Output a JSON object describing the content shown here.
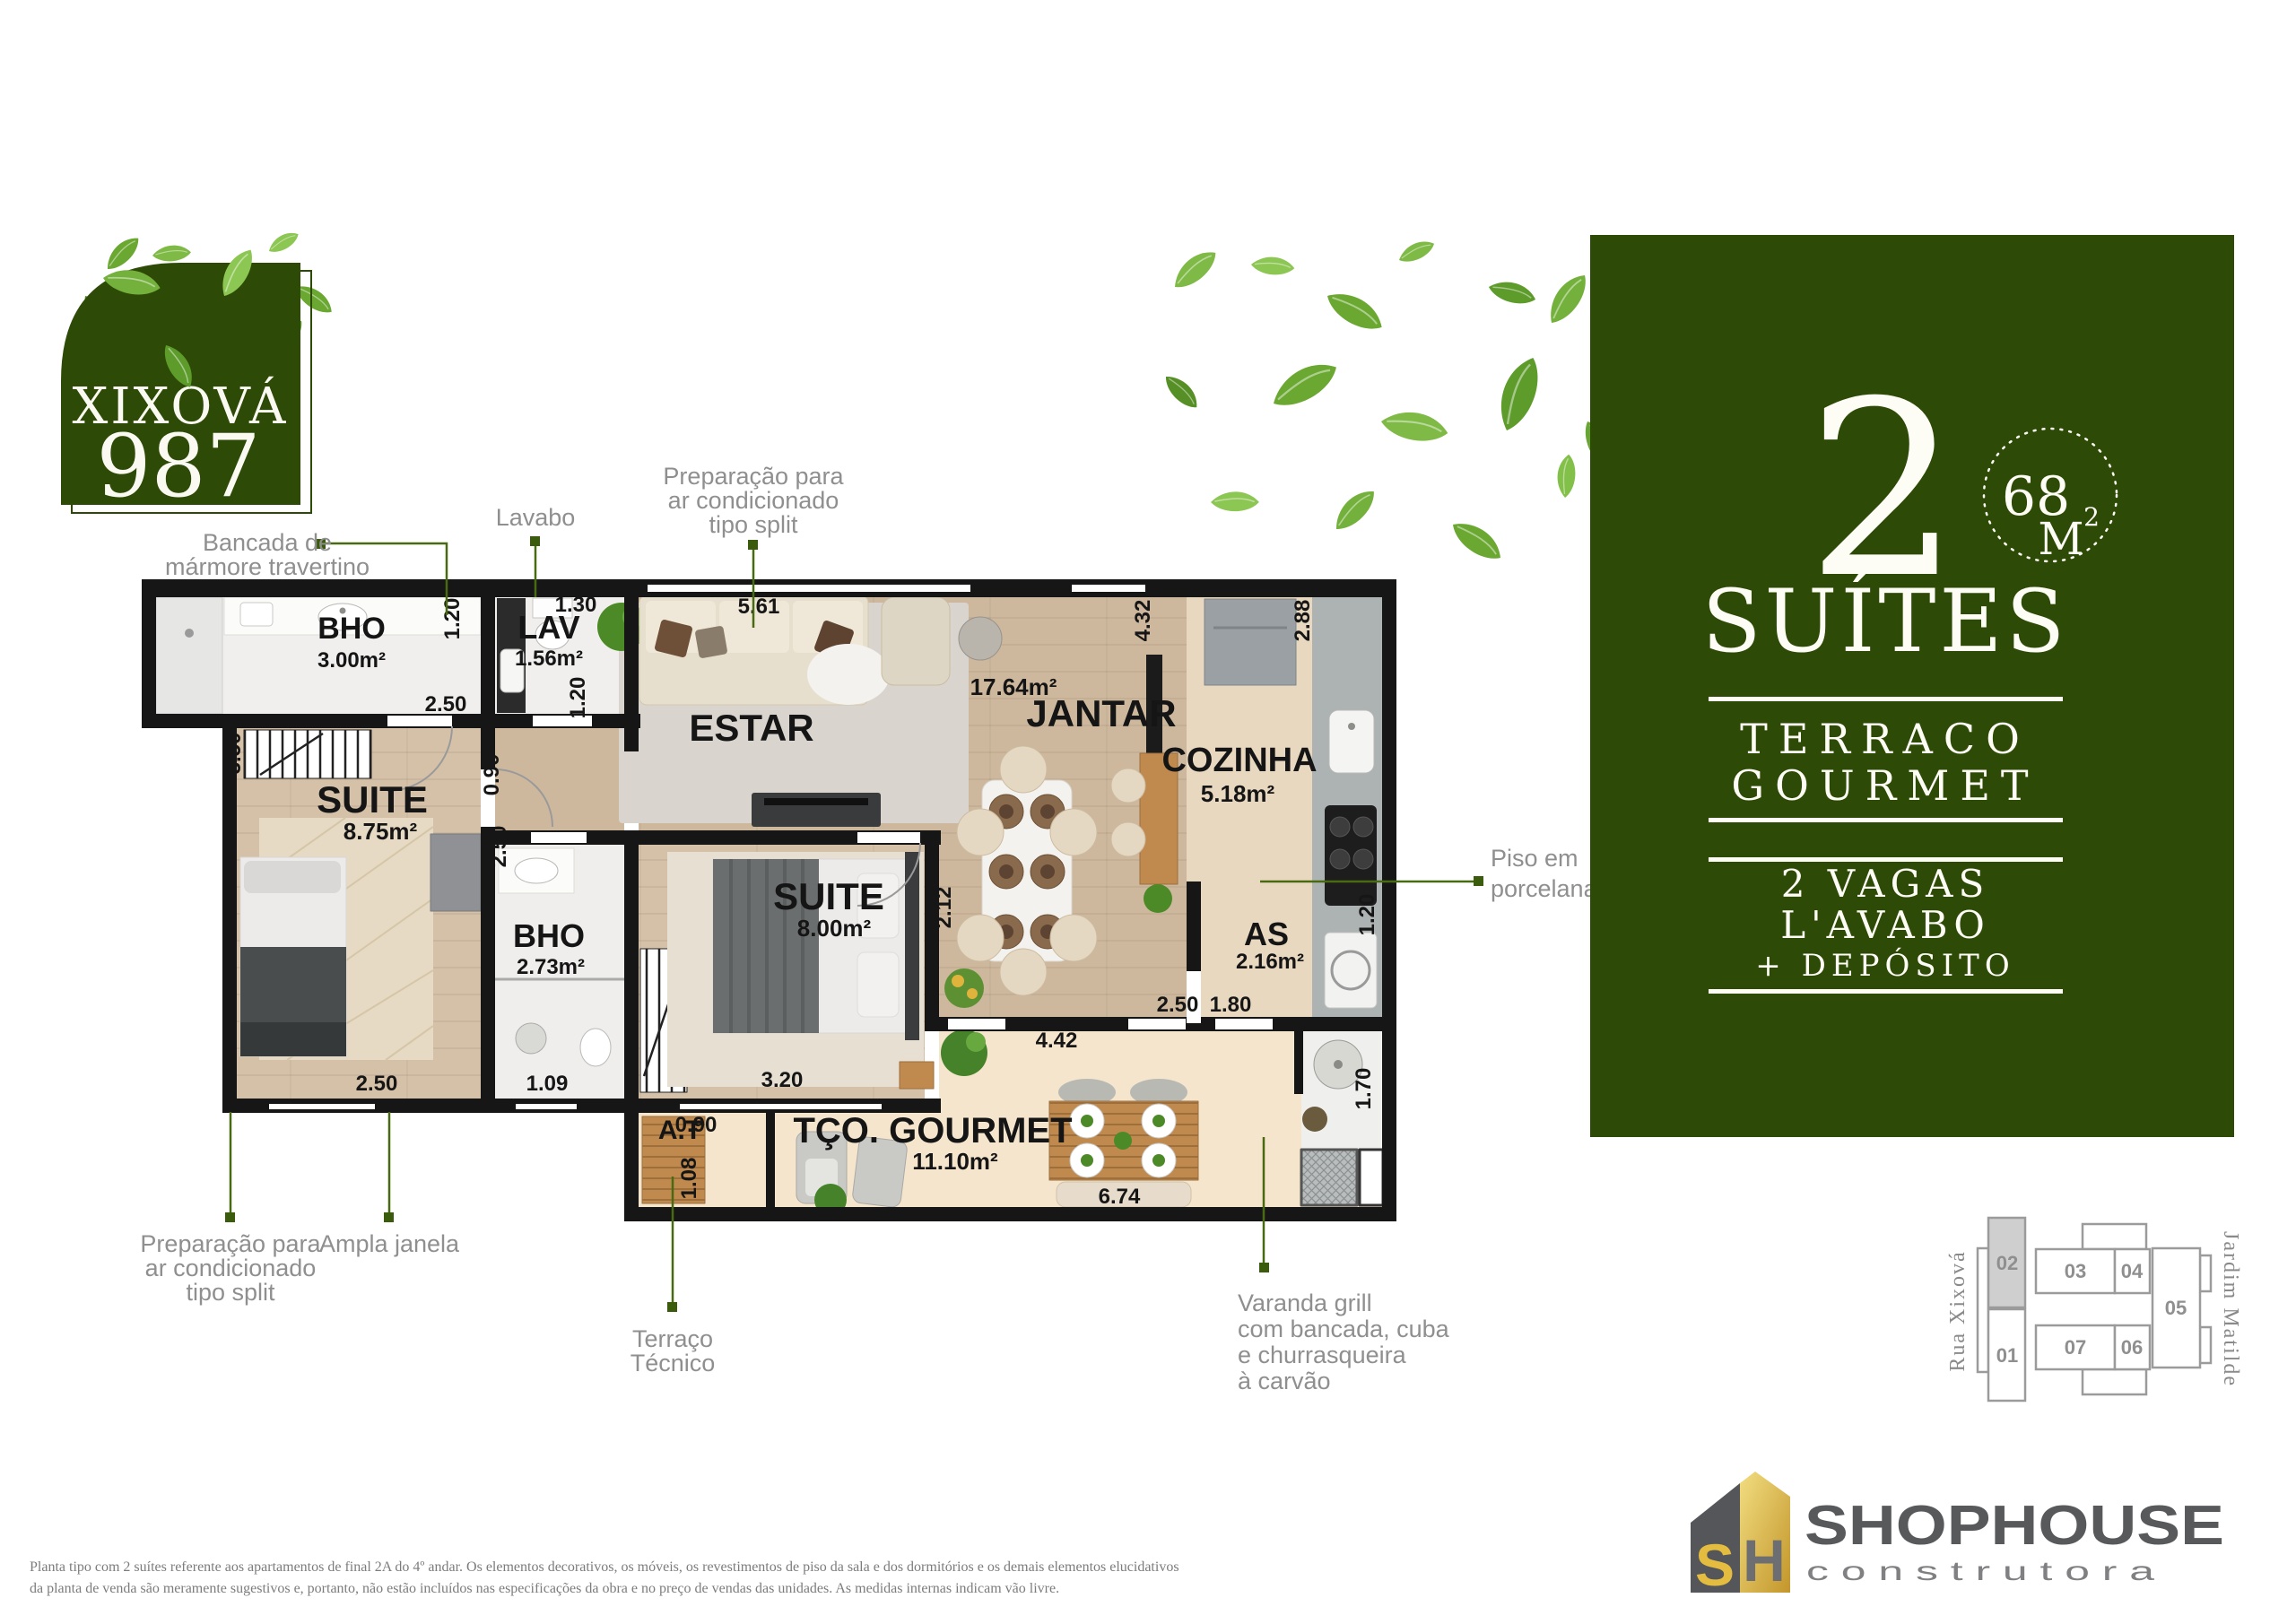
{
  "logo": {
    "name": "XIXOVÁ",
    "number": "987"
  },
  "panel": {
    "big_number": "2",
    "badge": {
      "value": "68",
      "unit": "M",
      "sup": "2"
    },
    "headline": "SUÍTES",
    "feature_top": {
      "line1": "TERRACO",
      "line2": "GOURMET"
    },
    "features": {
      "line1": "2 VAGAS",
      "line2": "L'AVABO",
      "line3": "+ DEPÓSITO"
    }
  },
  "plan": {
    "rooms": {
      "bho1": {
        "name": "BHO",
        "area": "3.00m²"
      },
      "lav": {
        "name": "LAV",
        "area": "1.56m²"
      },
      "estar": {
        "name": "ESTAR"
      },
      "jantar": {
        "name": "JANTAR",
        "area": "17.64m²"
      },
      "cozinha": {
        "name": "COZINHA",
        "area": "5.18m²"
      },
      "as": {
        "name": "AS",
        "area": "2.16m²"
      },
      "suite1": {
        "name": "SUITE",
        "area": "8.75m²"
      },
      "bho2": {
        "name": "BHO",
        "area": "2.73m²"
      },
      "suite2": {
        "name": "SUITE",
        "area": "8.00m²"
      },
      "gourmet": {
        "name": "TÇO. GOURMET",
        "area": "11.10m²"
      },
      "at": {
        "name": "A.T"
      }
    },
    "dims": {
      "d1": "1.20",
      "d2": "1.30",
      "d3": "5.61",
      "d4": "4.32",
      "d5": "2.88",
      "d6": "2.50",
      "d7": "1.20",
      "d8": "0.90",
      "d9": "3.50",
      "d10": "2.50",
      "d11": "2.50",
      "d12": "1.09",
      "d13": "3.20",
      "d14": "0.90",
      "d15": "1.08",
      "d16": "2.12",
      "d17": "4.42",
      "d18": "6.74",
      "d19": "2.50",
      "d20": "1.80",
      "d21": "1.20",
      "d22": "1.70"
    },
    "callouts": {
      "bancada": {
        "l1": "Bancada de",
        "l2": "mármore travertino"
      },
      "lavabo": {
        "l1": "Lavabo"
      },
      "prep_top": {
        "l1": "Preparação para",
        "l2": "ar condicionado",
        "l3": "tipo split"
      },
      "piso": {
        "l1": "Piso em",
        "l2": "porcelanato"
      },
      "prep_bottom": {
        "l1": "Preparação para",
        "l2": "ar condicionado",
        "l3": "tipo split"
      },
      "ampla": {
        "l1": "Ampla janela"
      },
      "terraco_tecnico": {
        "l1": "Terraço",
        "l2": "Técnico"
      },
      "varanda": {
        "l1": "Varanda grill",
        "l2": "com bancada, cuba",
        "l3": "e churrasqueira",
        "l4": "à carvão"
      }
    }
  },
  "keyplan": {
    "street_left": "Rua Xixová",
    "street_right": "Jardim Matilde",
    "units": {
      "u1": "01",
      "u2": "02",
      "u3": "03",
      "u4": "04",
      "u5": "05",
      "u6": "06",
      "u7": "07"
    }
  },
  "brand": {
    "mark_s": "S",
    "mark_h": "H",
    "name": "SHOPHOUSE",
    "tagline": "c o n s t r u t o r a"
  },
  "disclaimer": {
    "line1": "Planta tipo com 2 suítes referente aos apartamentos de final 2A do 4º andar. Os elementos decorativos, os móveis, os revestimentos de piso da sala e dos dormitórios e os demais elementos elucidativos",
    "line2": "da planta de venda são meramente sugestivos e, portanto, não estão incluídos nas especificações da obra e no preço de vendas das unidades. As medidas internas indicam vão livre."
  },
  "colors": {
    "brand_green": "#2d4a06",
    "leader_green": "#486b12",
    "label_gray": "#8f8f8f",
    "gold": "#d9b63e"
  }
}
